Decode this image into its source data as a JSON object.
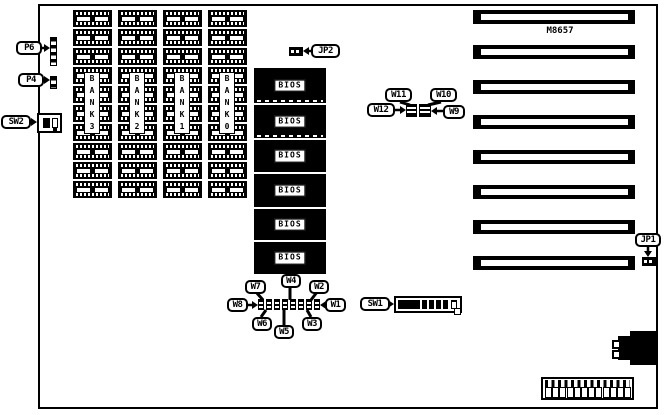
{
  "diagram": {
    "model_label": "M8657",
    "memory_banks": [
      "BANK3",
      "BANK2",
      "BANK1",
      "BANK0"
    ],
    "bios_chips": [
      "BIOS",
      "BIOS",
      "BIOS",
      "BIOS",
      "BIOS",
      "BIOS"
    ],
    "expansion_slot_count": 8,
    "callouts": {
      "p6": "P6",
      "p4": "P4",
      "sw2": "SW2",
      "jp2": "JP2",
      "w11": "W11",
      "w10": "W10",
      "w12": "W12",
      "w9": "W9",
      "jp1": "JP1",
      "sw1": "SW1",
      "w7": "W7",
      "w4": "W4",
      "w2": "W2",
      "w8": "W8",
      "w1": "W1",
      "w6": "W6",
      "w5": "W5",
      "w3": "W3"
    }
  }
}
